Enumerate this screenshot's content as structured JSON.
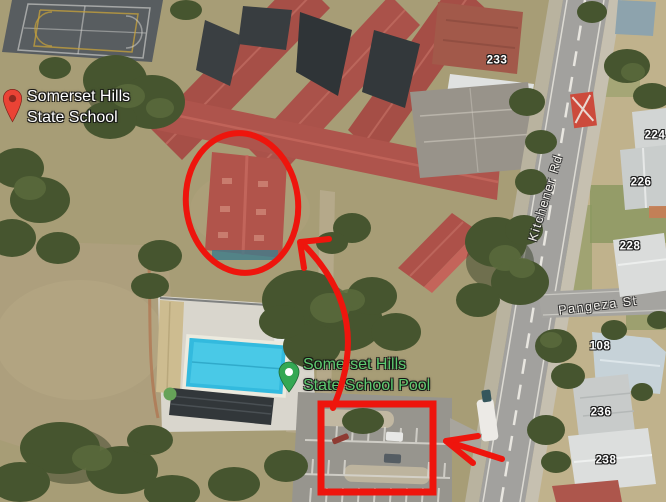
{
  "markers": {
    "school": {
      "line1": "Somerset Hills",
      "line2": "State School"
    },
    "pool": {
      "line1": "Somerset Hills",
      "line2": "State School Pool"
    }
  },
  "streets": {
    "kitchener": "Kitchener Rd",
    "pangeza": "Pangeza St"
  },
  "house_numbers": {
    "n233": "233",
    "n224": "224",
    "n226": "226",
    "n228": "228",
    "n108": "108",
    "n236": "236",
    "n238": "238"
  },
  "colors": {
    "annotation": "#ee150d",
    "school_pin": "#ea4335",
    "school_pin_dot": "#8f2a20",
    "pool_pin": "#34a853",
    "pool_pin_dot": "#ffffff"
  }
}
